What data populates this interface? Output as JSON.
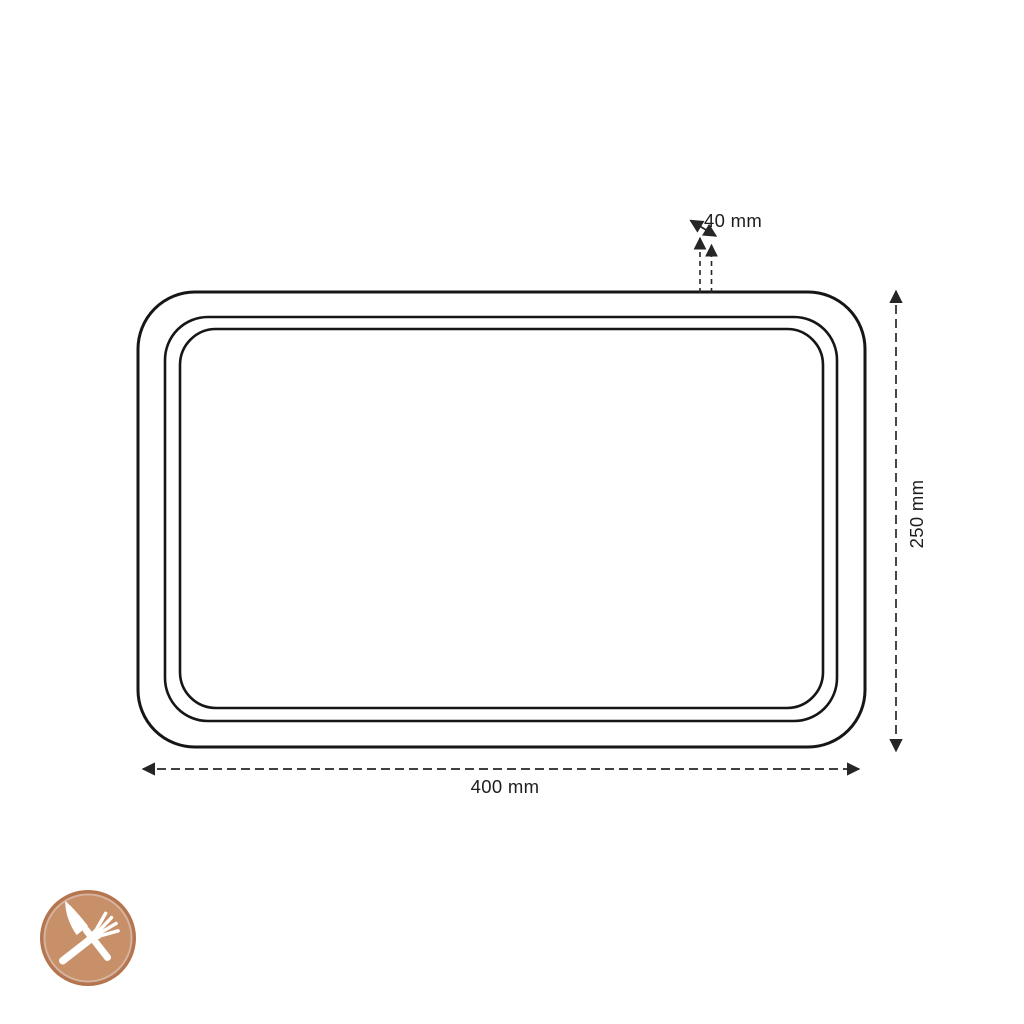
{
  "diagram": {
    "labels": {
      "width": "400 mm",
      "height": "250 mm",
      "rim": "40 mm"
    },
    "colors": {
      "outline": "#161616",
      "dimension": "#262626",
      "logo_ring": "#b5754f",
      "logo_disc": "#c89068",
      "logo_cutlery": "#ffffff"
    },
    "icons": {
      "logo": "knife-and-fork-crossed"
    }
  }
}
